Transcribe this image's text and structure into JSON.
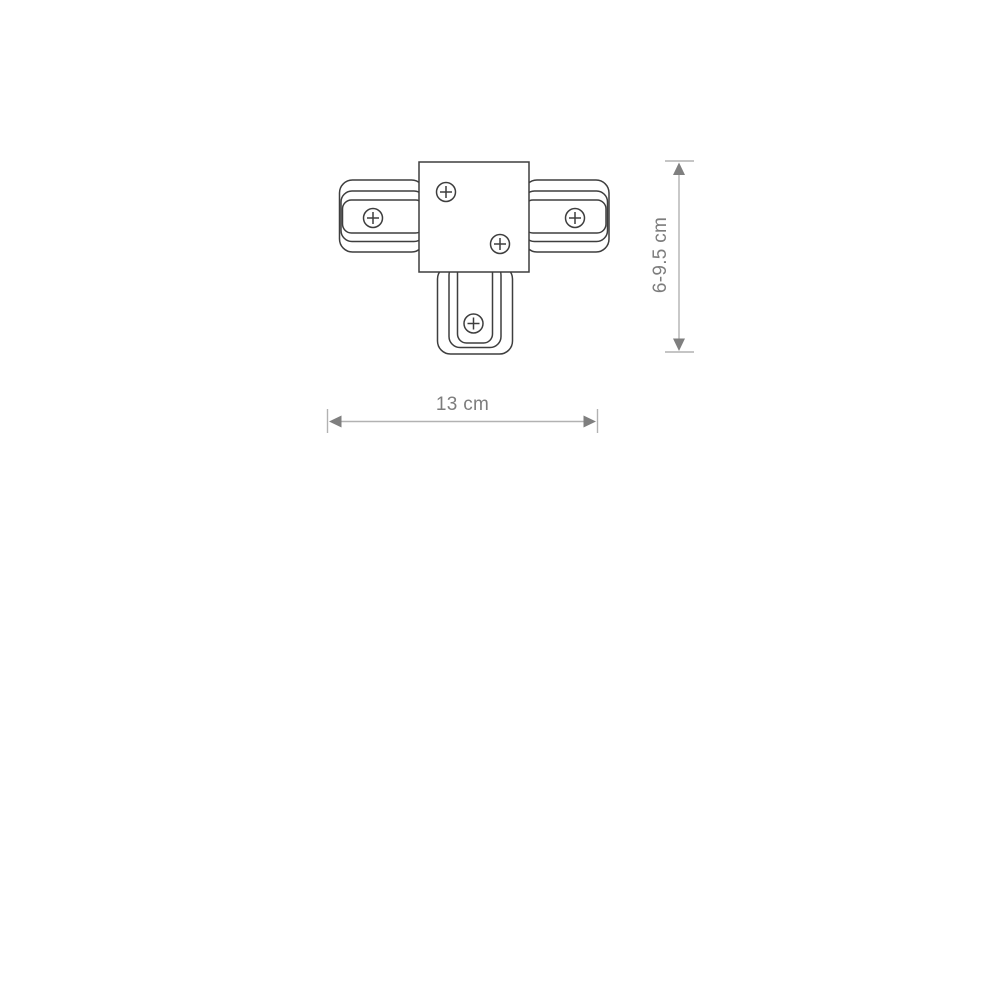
{
  "drawing": {
    "title": "T-connector technical drawing",
    "screw_count": 5
  },
  "dimensions": {
    "width_label": "13 cm",
    "height_label": "6-9.5 cm"
  },
  "colors": {
    "outline": "#3e3e3e",
    "dimension_line": "#b2b2b2",
    "dimension_arrow": "#7f7f7f",
    "dimension_text": "#7d7d7d"
  }
}
